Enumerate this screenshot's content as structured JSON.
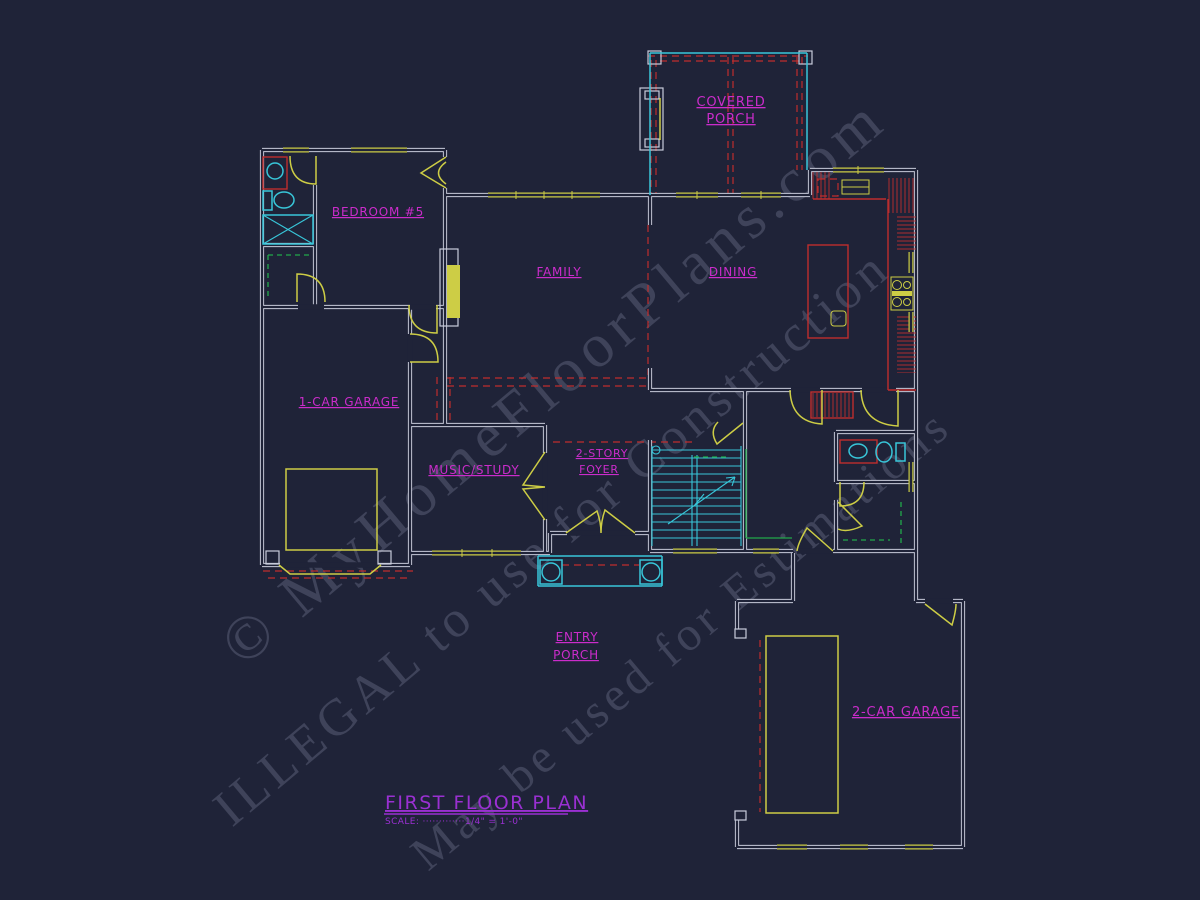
{
  "canvas": {
    "width": 1200,
    "height": 900,
    "background": "#1f2338"
  },
  "palette": {
    "wall": "#c9ccdb",
    "cyan": "#38c6d9",
    "yellow": "#cdcd45",
    "red": "#bf2d2d",
    "green": "#22a84a",
    "magenta": "#cb2ccb",
    "title_purple": "#9a30d2",
    "watermark_gray": "#9aa1ba"
  },
  "labels": {
    "covered_porch_line1": "COVERED",
    "covered_porch_line2": "PORCH",
    "bedroom5": "BEDROOM #5",
    "family": "FAMILY",
    "dining": "DINING",
    "one_car_garage": "1-CAR GARAGE",
    "music_study": "MUSIC/STUDY",
    "foyer_line1": "2-STORY",
    "foyer_line2": "FOYER",
    "entry_porch_line1": "ENTRY",
    "entry_porch_line2": "PORCH",
    "two_car_garage": "2-CAR GARAGE"
  },
  "title_block": {
    "title": "FIRST FLOOR PLAN",
    "scale": "SCALE: ·············1/4\" = 1'-0\""
  },
  "watermark": {
    "line1": "© MyHomeFloorPlans.com",
    "line2": "ILLEGAL to use for Construction",
    "line3": "May be used for Estimations"
  }
}
